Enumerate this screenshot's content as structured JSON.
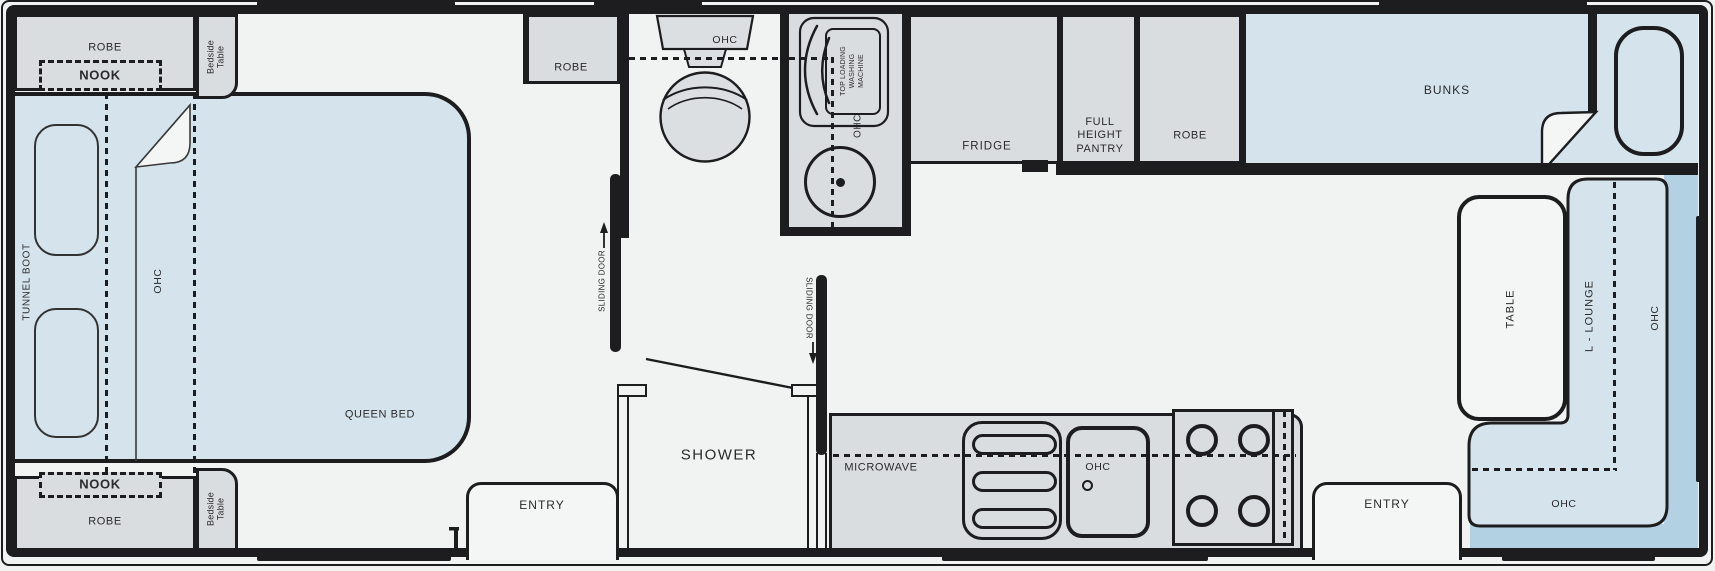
{
  "title": "Caravan floor plan",
  "colors": {
    "wall": "#1d1d1f",
    "floor": "#f1f2f2",
    "cabinet": "#d9dde0",
    "mattress": "#d5e4ec",
    "dark": "#b2d2e3",
    "ink": "#2a2a2c"
  },
  "plan": {
    "front_bedroom": {
      "robe_top": "ROBE",
      "nook_top": "NOOK",
      "bedside_table_top": "Bedside\nTable",
      "tunnel_boot": "TUNNEL BOOT",
      "ohc": "OHC",
      "queen_bed": "QUEEN BED",
      "nook_bottom": "NOOK",
      "robe_bottom": "ROBE",
      "bedside_table_bottom": "Bedside\nTable"
    },
    "bathroom": {
      "robe": "ROBE",
      "toilet_ohc": "OHC",
      "washing_machine": "TOP LOADING\nWASHING\nMACHINE",
      "washing_ohc": "OHC",
      "sliding_door_bedroom": "SLIDING DOOR",
      "sliding_door_kitchen": "SLIDING DOOR",
      "shower": "SHOWER"
    },
    "kitchen": {
      "microwave": "MICROWAVE",
      "sink_ohc": "OHC",
      "fridge": "FRIDGE",
      "pantry": "FULL\nHEIGHT\nPANTRY",
      "robe": "ROBE"
    },
    "rear_living": {
      "bunks": "BUNKS",
      "table": "TABLE",
      "lounge": "L - LOUNGE",
      "lounge_ohc_side": "OHC",
      "lounge_ohc_rear": "OHC"
    },
    "entries": {
      "entry_front": "ENTRY",
      "entry_rear": "ENTRY"
    }
  }
}
